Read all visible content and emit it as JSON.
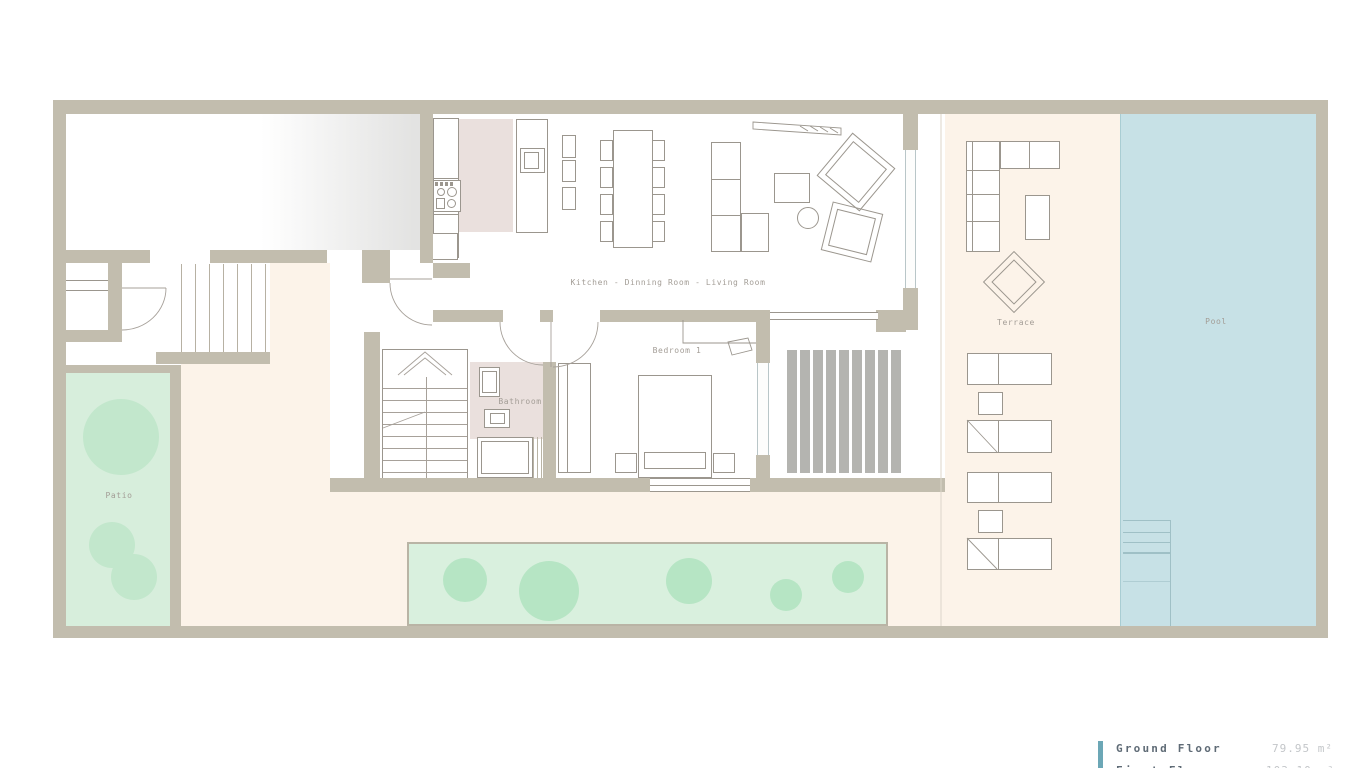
{
  "palette": {
    "wall": "#c2bdae",
    "line": "#9b968e",
    "cream": "#fcf3e9",
    "pool": "#c7e1e6",
    "poolEdge": "#a9cdd3",
    "patioGreen": "#d7eedc",
    "plantGreen": "#c2e7cc",
    "gardenGreen": "#d9f0de",
    "gardenPlant": "#b6e5c4",
    "deckGray": "#b4b4b0",
    "pinkFloor": "#eae0dd",
    "labelColor": "#a39d96",
    "glass": "#b9c6c8",
    "legendBar": "#6ca7b6",
    "legendText": "#5f6b76",
    "legendValue": "#c3c6c9",
    "stepLine": "#9fc0c6"
  },
  "labels": {
    "kitchen_dining_living": "Kitchen - Dinning Room - Living Room",
    "bedroom": "Bedroom 1",
    "bathroom": "Bathroom",
    "patio": "Patio",
    "terrace": "Terrace",
    "pool": "Pool"
  },
  "legend": {
    "rows": [
      {
        "label": "Ground Floor",
        "value": "79.95 m²"
      },
      {
        "label": "First Floor",
        "value": "103.10 m²"
      }
    ]
  }
}
